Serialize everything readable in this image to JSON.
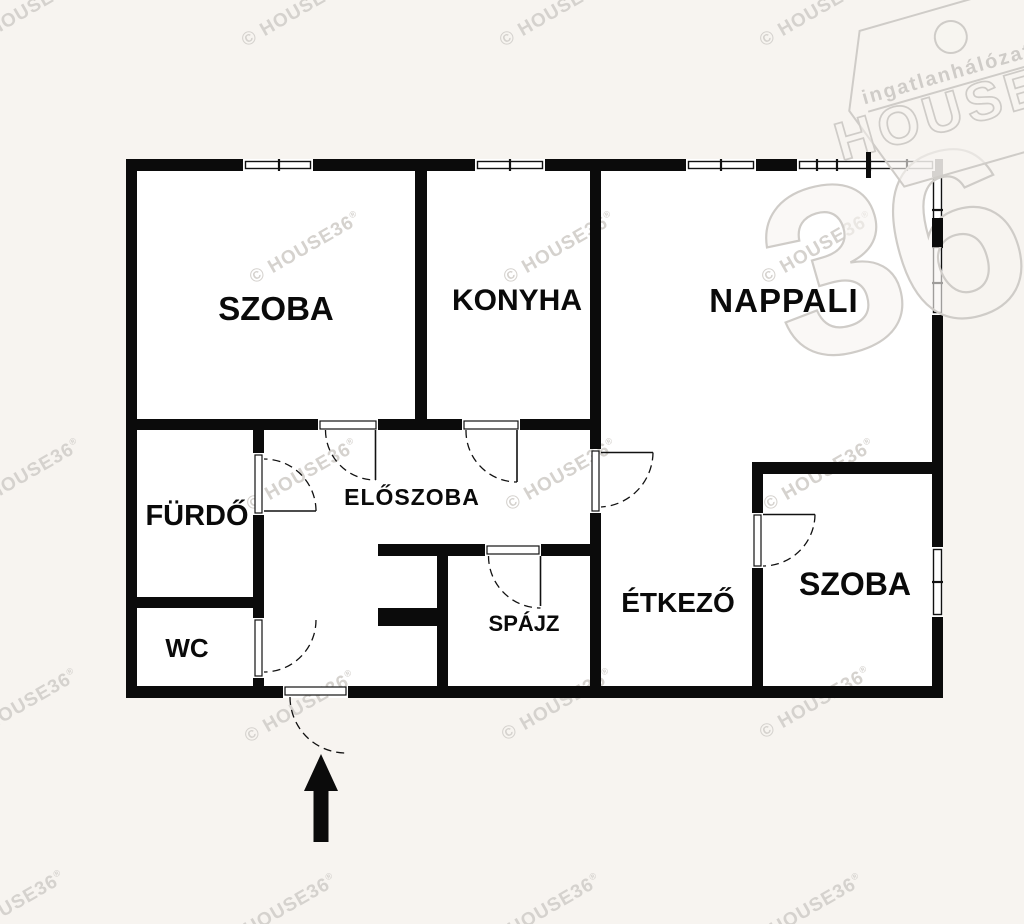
{
  "colors": {
    "page_bg": "#f7f4f0",
    "plan_bg": "#ffffff",
    "wall": "#0b0b0b",
    "line": "#1a1a1a",
    "watermark": "#d5d2ce",
    "watermark_bold": "#ccc9c5",
    "logo_outline": "#cfccc8",
    "logo_fill": "rgba(247,244,240,0.62)"
  },
  "rooms": [
    {
      "id": "szoba-1",
      "label": "SZOBA"
    },
    {
      "id": "konyha",
      "label": "KONYHA"
    },
    {
      "id": "nappali",
      "label": "NAPPALI"
    },
    {
      "id": "furdo",
      "label": "FÜRDŐ"
    },
    {
      "id": "eloszoba",
      "label": "ELŐSZOBA"
    },
    {
      "id": "wc",
      "label": "WC"
    },
    {
      "id": "spajz",
      "label": "SPÁJZ"
    },
    {
      "id": "etkezo",
      "label": "ÉTKEZŐ"
    },
    {
      "id": "szoba-2",
      "label": "SZOBA"
    }
  ],
  "watermark": {
    "text": "© HOUSE36",
    "registered": "®"
  },
  "logo": {
    "network": "ingatlanhálózat",
    "brand": "HOUSE",
    "number": "36"
  }
}
